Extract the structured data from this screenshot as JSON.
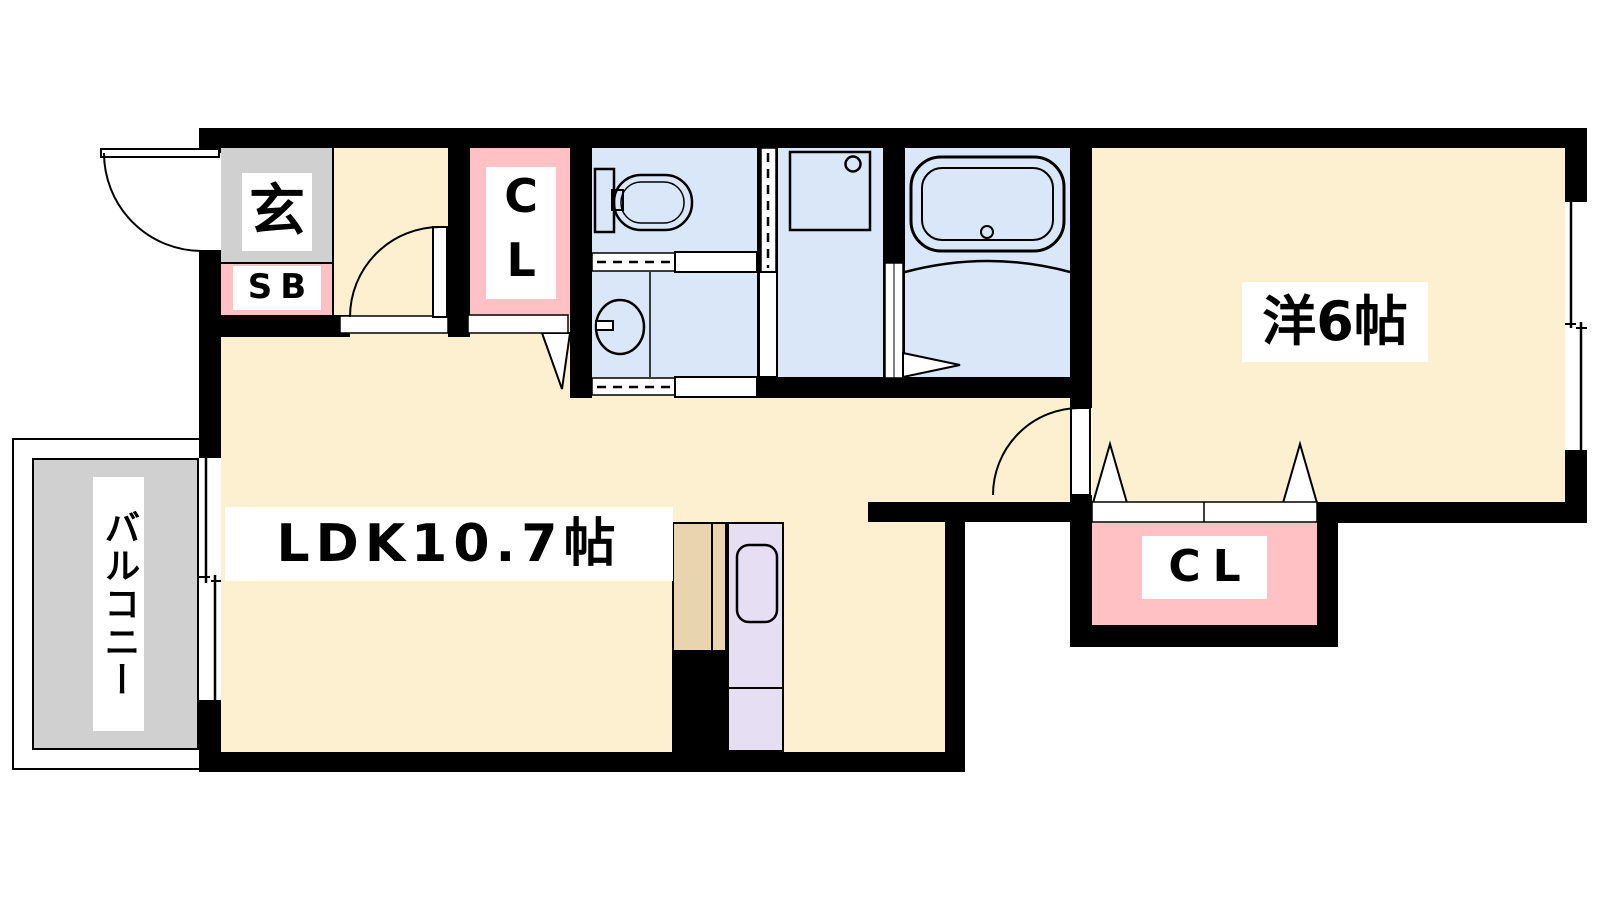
{
  "floor_plan": {
    "rooms": {
      "entrance": {
        "label": "玄"
      },
      "shoe_box": {
        "label": "SB"
      },
      "closet_upper": {
        "label": "CL"
      },
      "ldk": {
        "label": "LDK10.7帖"
      },
      "western_room": {
        "label": "洋6帖"
      },
      "closet_lower": {
        "label": "CL"
      },
      "balcony": {
        "label": "バルコニー"
      }
    },
    "fixtures": [
      "toilet",
      "washbasin",
      "washing-machine-pan",
      "bathtub",
      "kitchen-sink",
      "kitchen-counter"
    ],
    "colors": {
      "wall_black": "#000000",
      "floor_cream": "#fdf0d0",
      "closet_pink": "#ffc1c4",
      "wet_area_blue": "#d9e7f8",
      "entrance_gray": "#d0d0d0",
      "balcony_gray": "#d0d0d0",
      "counter_tan": "#e8d5b0",
      "kitchen_lavender": "#e6def2"
    }
  }
}
